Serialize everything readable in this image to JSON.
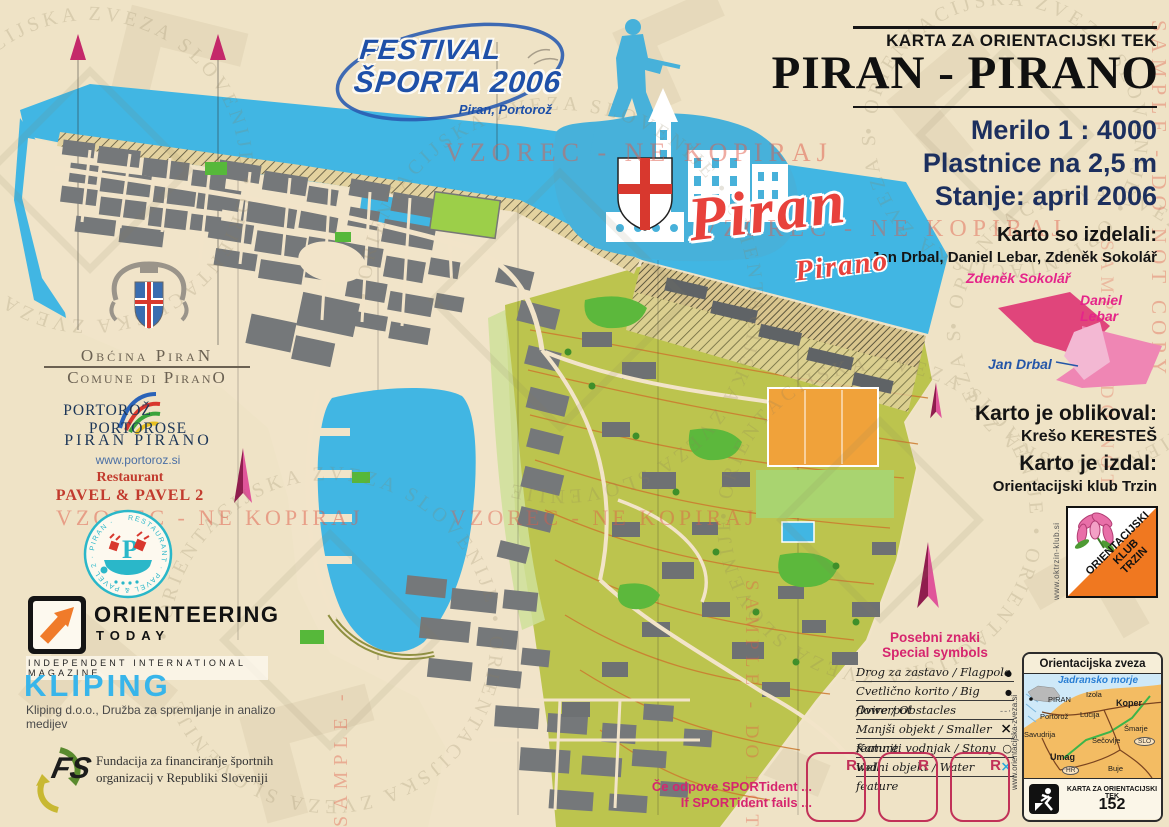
{
  "title_block": {
    "kicker": "KARTA ZA ORIENTACIJSKI TEK",
    "title": "PIRAN - PIRANO",
    "scale": "Merilo 1 : 4000",
    "contour_interval": "Plastnice na 2,5 m",
    "status": "Stanje: april 2006"
  },
  "credits": {
    "surveyors_label": "Karto so izdelali:",
    "surveyors": "Jan Drbal, Daniel Lebar, Zdeněk Sokolář",
    "area_sokolar": "Zdeněk Sokolář",
    "area_lebar": "Daniel Lebar",
    "area_drbal": "Jan Drbal",
    "designer_label": "Karto je oblikoval:",
    "designer": "Krešo KERESTEŠ",
    "publisher_label": "Karto je izdal:",
    "publisher": "Orientacijski klub Trzin"
  },
  "club": {
    "name_line1": "ORIENTACIJSKI",
    "name_line2": "KLUB",
    "name_line3": "TRZIN",
    "website": "www.oktrzin-klub.si"
  },
  "festival": {
    "line1": "FESTIVAL",
    "line2": "ŠPORTA 2006",
    "subtitle": "Piran, Portorož"
  },
  "map_labels": {
    "main": "Piran",
    "sub": "Pirano"
  },
  "legend": {
    "title_sl": "Posebni znaki",
    "title_en": "Special symbols",
    "items": [
      {
        "label": "Drog za zastavo / Flagpole",
        "symbol": "dot"
      },
      {
        "label": "Cvetlično korito / Big flowerpot",
        "symbol": "dot"
      },
      {
        "label": "Ovire / Obstacles",
        "symbol": "dashes"
      },
      {
        "label": "Manjši objekt / Smaller feature",
        "symbol": "x-black"
      },
      {
        "label": "Kamniti vodnjak / Stony well",
        "symbol": "circle"
      },
      {
        "label": "Vodni objekt / Water feature",
        "symbol": "x-blue"
      }
    ]
  },
  "ozs_box": {
    "title": "Orientacijska zveza Slovenije",
    "sea_label": "Jadransko morje",
    "towns": [
      "PIRAN",
      "Izola",
      "Koper",
      "Portorož",
      "Lucija",
      "Šmarje",
      "Sečovlje",
      "Savudrija",
      "Umag",
      "Buje"
    ],
    "codes": [
      "SLO",
      "HR"
    ],
    "website": "www.orientacijska-zveza.si",
    "footer_label": "KARTA ZA ORIENTACIJSKI TEK",
    "map_number": "152"
  },
  "sportident": {
    "line_sl": "Če odpove SPORTident ...",
    "line_en": "If SPORTident fails ...",
    "reserve_label": "R"
  },
  "sponsors": {
    "municipality": {
      "line1": "Obćina PiraN",
      "line2": "Comune di PiranO"
    },
    "portoroz": {
      "name_left": "PORTOROŽ",
      "name_right": "PORTOROSE",
      "line2": "PIRAN  PIRANO",
      "website": "www.portoroz.si"
    },
    "restaurant": {
      "line1": "Restaurant",
      "line2": "PAVEL  &  PAVEL 2",
      "ring_text": "RESTAURANT · PAVEL & PAVEL 2 · PIRAN ·"
    },
    "orienteering_today": {
      "name": "ORIENTEERING",
      "sub": "TODAY",
      "tagline": "INDEPENDENT  INTERNATIONAL  MAGAZINE"
    },
    "kliping": {
      "name": "KLIPING",
      "tagline": "Kliping d.o.o., Družba za spremljanje in analizo medijev"
    },
    "foundation": {
      "abbr": "FS",
      "line1": "Fundacija za financiranje športnih",
      "line2": "organizacij v Republiki Sloveniji"
    }
  },
  "watermarks": {
    "vzorec": "VZOREC - NE KOPIRAJ",
    "sample": "SAMPLE - DO NOT COPY",
    "stamp": "• ORIENTACIJSKA ZVEZA SLOVENIJE • ORIENTACIJSKA ZVEZA SLOVENIJE "
  },
  "colors": {
    "sea": "#41b6e3",
    "paved": "#f1e4c9",
    "building": "#75787a",
    "open_olive": "#bcc44e",
    "contour_orange": "#cc7a2e",
    "magenta": "#d6256e",
    "watermark_red": "#e05a48",
    "title_navy": "#1c2f5e",
    "club_orange": "#f07820"
  }
}
